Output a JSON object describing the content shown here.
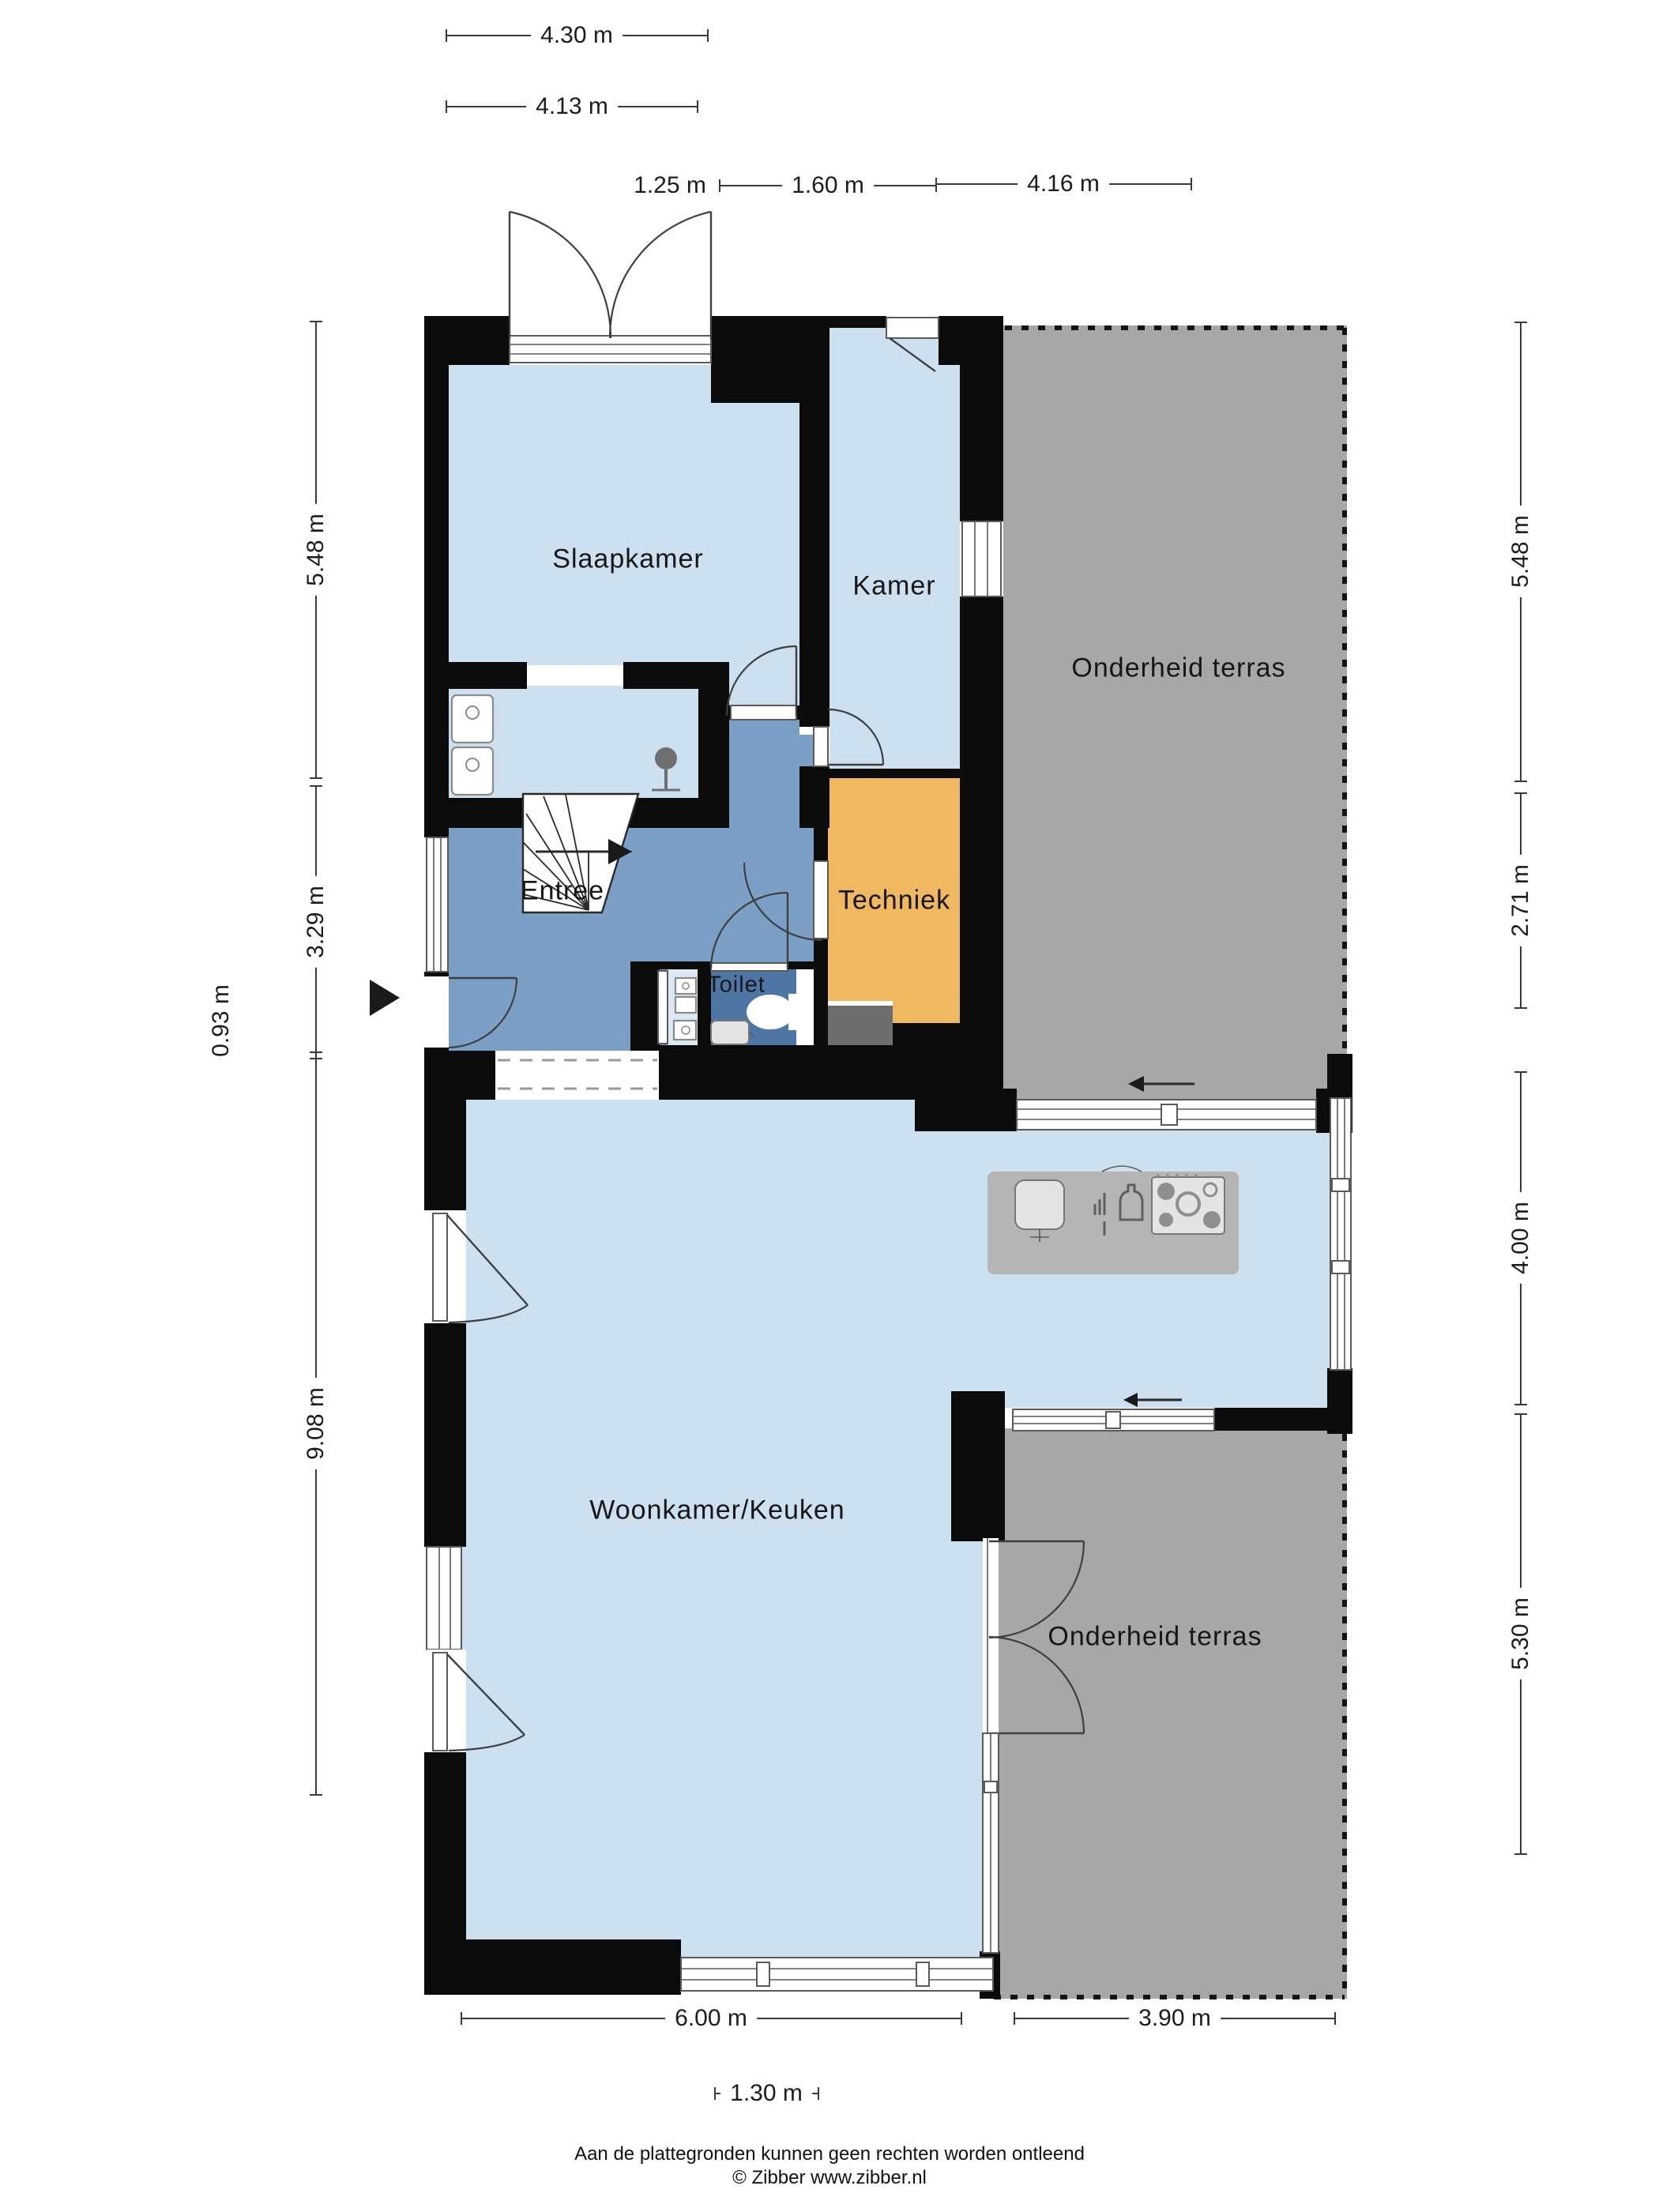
{
  "rooms": {
    "slaapkamer": "Slaapkamer",
    "kamer": "Kamer",
    "entree": "Entree",
    "techniek": "Techniek",
    "toilet": "Toilet",
    "woonkamer": "Woonkamer/Keuken",
    "terras_boven": "Onderheid terras",
    "terras_onder": "Onderheid terras"
  },
  "dims": {
    "d430": "4.30 m",
    "d413": "4.13 m",
    "d125": "1.25 m",
    "d160": "1.60 m",
    "d416": "4.16 m",
    "d548l": "5.48 m",
    "d329": "3.29 m",
    "d093": "0.93 m",
    "d908": "9.08 m",
    "d548r": "5.48 m",
    "d271": "2.71 m",
    "d400": "4.00 m",
    "d530": "5.30 m",
    "d600": "6.00 m",
    "d390": "3.90 m",
    "d130": "1.30 m"
  },
  "footer": {
    "disclaimer": "Aan de plattegronden kunnen geen rechten worden ontleend",
    "copyright": "© Zibber www.zibber.nl"
  },
  "icons": {
    "entrance_arrow": "right-triangle",
    "slide_arrow": "left-arrow",
    "stairs": "stairs-icon",
    "shower": "shower-icon",
    "washbasin": "washbasin-icon",
    "wc": "toilet-icon",
    "fusebox": "fusebox-icon",
    "sink": "sink-icon",
    "dishwasher": "dishwasher-icon",
    "hob": "hob-icon"
  },
  "colors": {
    "wall": "#0b0b0b",
    "room": "#cde0ef",
    "entree": "#7c9fc5",
    "toilet": "#4e76a4",
    "tech": "#f0b860",
    "terras": "#a7a7a7",
    "counter": "#9e9e9e",
    "mat": "#6e6e6e",
    "meter": "#dce8f3"
  }
}
